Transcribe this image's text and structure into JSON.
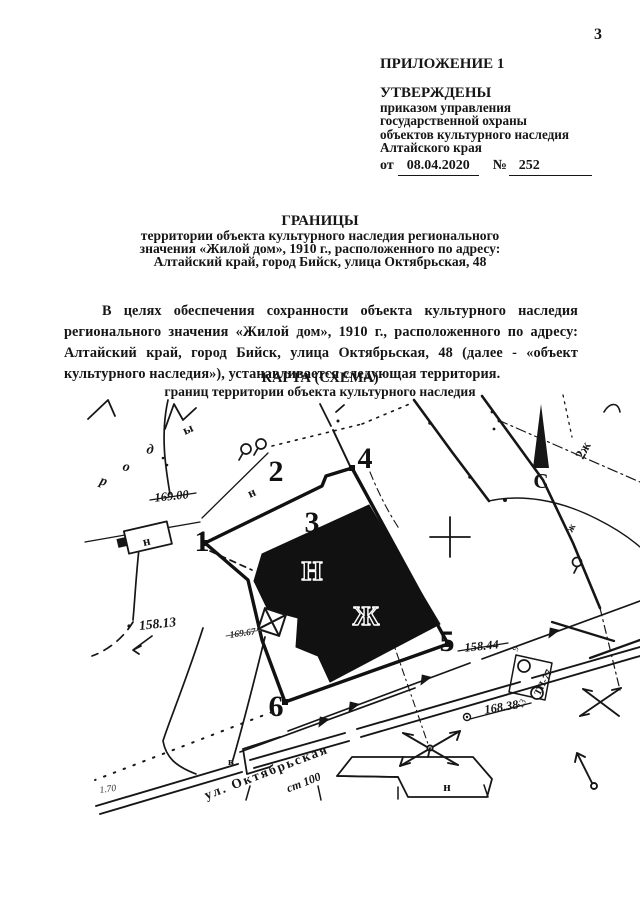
{
  "page": {
    "number": "3"
  },
  "header": {
    "appendix": "ПРИЛОЖЕНИЕ 1",
    "approved": "УТВЕРЖДЕНЫ",
    "by_line1": "приказом управления",
    "by_line2": "государственной охраны",
    "by_line3": "объектов культурного наследия",
    "by_line4": "Алтайского края",
    "date_prefix": "от",
    "date": "08.04.2020",
    "number_sign": "№",
    "order_number": "252"
  },
  "title": {
    "line1": "ГРАНИЦЫ",
    "line2": "территории объекта культурного наследия регионального",
    "line3": "значения «Жилой дом», 1910 г., расположенного по адресу:",
    "line4": "Алтайский край, город Бийск, улица Октябрьская, 48"
  },
  "body": {
    "paragraph": "В целях обеспечения сохранности объекта культурного наследия регионального значения «Жилой дом», 1910 г., расположенного по адресу: Алтайский край, город Бийск, улица Октябрьская, 48 (далее - «объект культурного наследия»), устанавливается следующая территория."
  },
  "map": {
    "heading1": "КАРТА (СХЕМА)",
    "heading2": "границ территории объекта культурного наследия",
    "north": "С",
    "points": {
      "p1": "1",
      "p2": "2",
      "p3": "3",
      "p4": "4",
      "p5": "5",
      "p6": "6"
    },
    "building": {
      "top": "Н",
      "center": "Ж"
    },
    "street": "ул. Октябрьская",
    "labels": {
      "elev1": "169.00",
      "elev2": "158.13",
      "elev3": "169.67",
      "elev4": "158.44",
      "elev5": "168.38",
      "dim": "1.70",
      "st100": "ст 100",
      "tp": "ТП-77",
      "n": "н",
      "v": "в",
      "r": "р",
      "o": "о",
      "d": "д",
      "y": "ы",
      "zh2": "2ж",
      "zh": "ж",
      "nine": "9",
      "thirteen": "13"
    },
    "colors": {
      "ink": "#161616",
      "paper": "#ffffff"
    }
  }
}
